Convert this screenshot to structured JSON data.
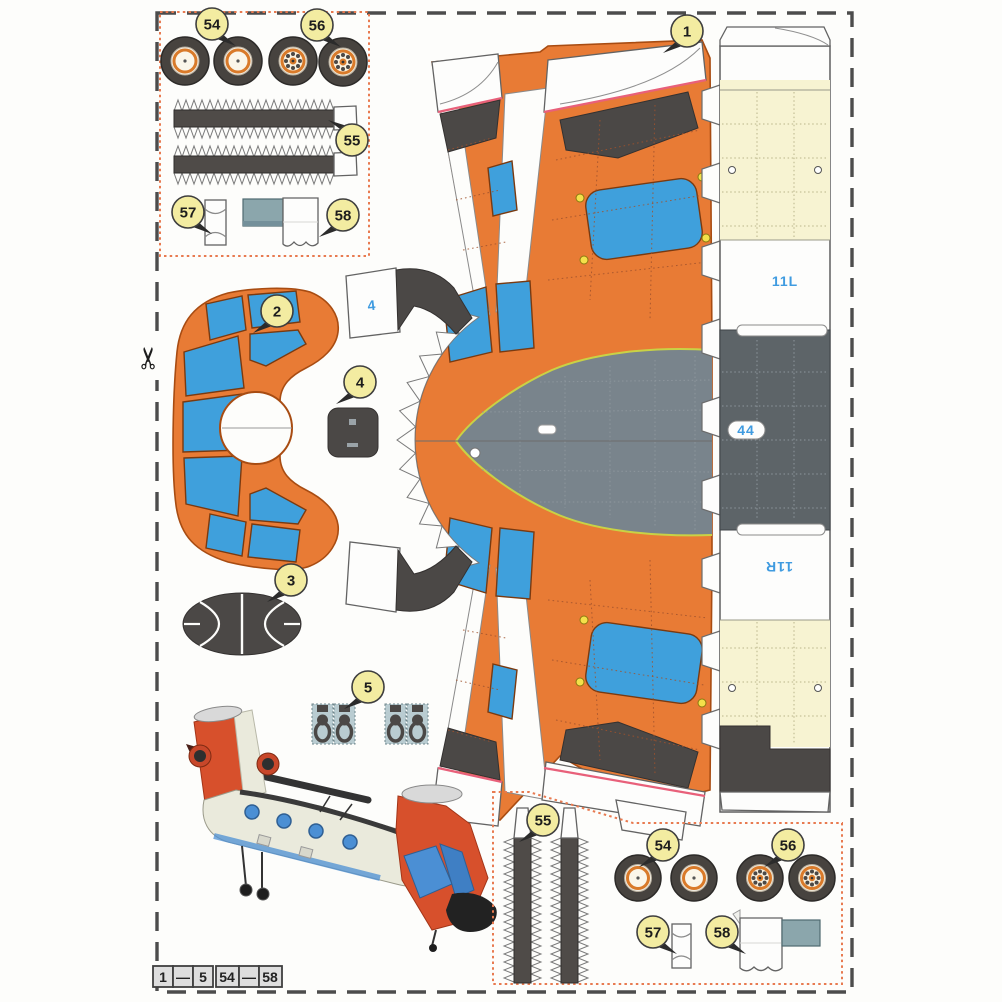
{
  "palette": {
    "fuselage_orange": "#e87b35",
    "window_blue": "#3fa0dc",
    "dark_gray": "#4b4846",
    "nose_gray": "#79848c",
    "pale_yellow": "#f7f3d2",
    "label_yellow": "#f3eca1",
    "cut_box_red": "#e87a50",
    "code_blue": "#3f9be0",
    "heli_red": "#d7502c",
    "heli_cream": "#eaeadc"
  },
  "parts": {
    "n1": "1",
    "n2": "2",
    "n3": "3",
    "n4": "4",
    "n5": "5",
    "n54": "54",
    "n55": "55",
    "n56": "56",
    "n57": "57",
    "n58": "58"
  },
  "codes": {
    "left_panel": "11L",
    "center_panel": "44",
    "right_panel": "11R",
    "glue_tab": "4"
  },
  "legend": {
    "cells": [
      "1",
      "—",
      "5",
      "54",
      "—",
      "58"
    ]
  }
}
